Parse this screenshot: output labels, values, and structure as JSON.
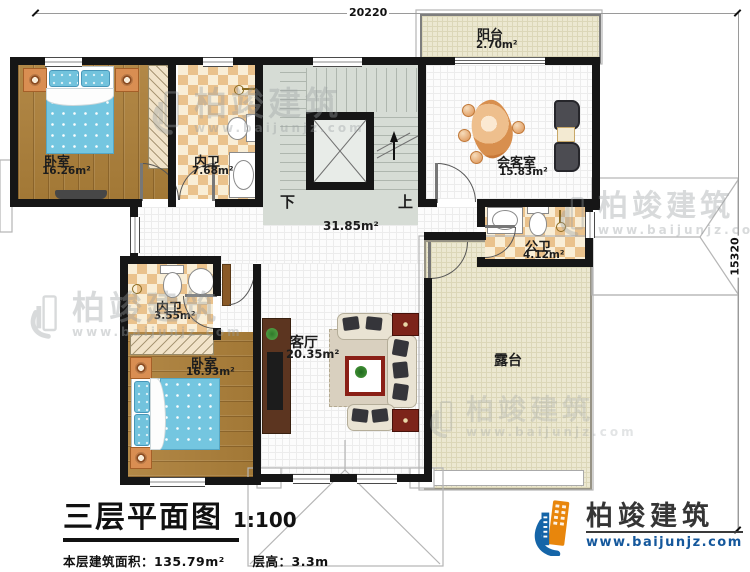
{
  "plan": {
    "dimensions": {
      "top": "20220",
      "right": "15320"
    },
    "rooms": {
      "balcony": {
        "name": "阳台",
        "area": "2.70m²"
      },
      "bedroom_tl": {
        "name": "卧室",
        "area": "16.26m²"
      },
      "bath_tl": {
        "name": "内卫",
        "area": "7.68m²"
      },
      "reception": {
        "name": "会客室",
        "area": "15.83m²"
      },
      "public_bath": {
        "name": "公卫",
        "area": "4.12m²"
      },
      "hall": {
        "area": "31.85m²"
      },
      "bath_bl": {
        "name": "内卫",
        "area": "3.55m²"
      },
      "bedroom_bl": {
        "name": "卧室",
        "area": "16.93m²"
      },
      "living": {
        "name": "客厅",
        "area": "20.35m²"
      },
      "terrace": {
        "name": "露台"
      }
    },
    "stairs": {
      "down": "下",
      "up": "上"
    }
  },
  "title": {
    "main": "三层平面图",
    "scale": "1:100",
    "area_label": "本层建筑面积：",
    "area_value": "135.79m²",
    "height_label": "层高：",
    "height_value": "3.3m"
  },
  "brand": {
    "name": "柏竣建筑",
    "url": "www.baijunjz.com"
  },
  "watermark": {
    "name": "柏竣建筑",
    "url": "www.baijunjz.com"
  },
  "colors": {
    "accent_blue": "#1565a8",
    "accent_orange": "#e8860c",
    "wall": "#161616"
  }
}
